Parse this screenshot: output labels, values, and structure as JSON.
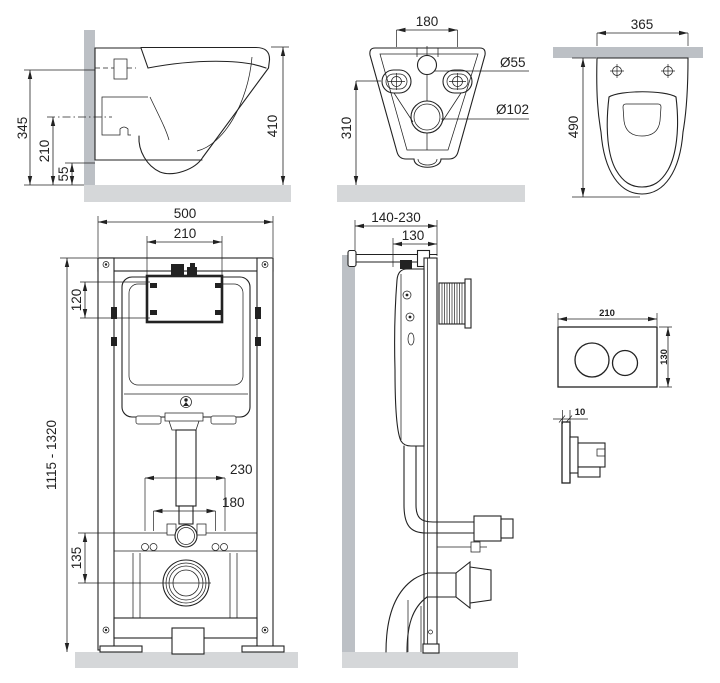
{
  "colors": {
    "line": "#222222",
    "wall": "#bcc0c5",
    "floor": "#d5d7d9",
    "background": "#ffffff"
  },
  "views": {
    "toilet_side": {
      "dim_height_total": "345",
      "dim_height_rim": "210",
      "dim_height_outlet": "55",
      "dim_height_bowl": "410"
    },
    "toilet_rear": {
      "dim_bolt_spacing": "180",
      "dim_inlet_diameter": "Ø55",
      "dim_outlet_diameter": "Ø102",
      "dim_outlet_height": "310"
    },
    "toilet_top": {
      "dim_width": "365",
      "dim_depth": "490"
    },
    "frame_front": {
      "dim_width": "500",
      "dim_window_width": "210",
      "dim_window_height": "120",
      "dim_height_range": "1115 - 1320",
      "dim_bolts_wide": "230",
      "dim_bolts_narrow": "180",
      "dim_drain_offset": "135"
    },
    "frame_side": {
      "dim_depth_range": "140-230",
      "dim_frame_depth": "130"
    },
    "flush_plate": {
      "dim_width": "210",
      "dim_height": "130",
      "dim_thickness": "10"
    }
  }
}
